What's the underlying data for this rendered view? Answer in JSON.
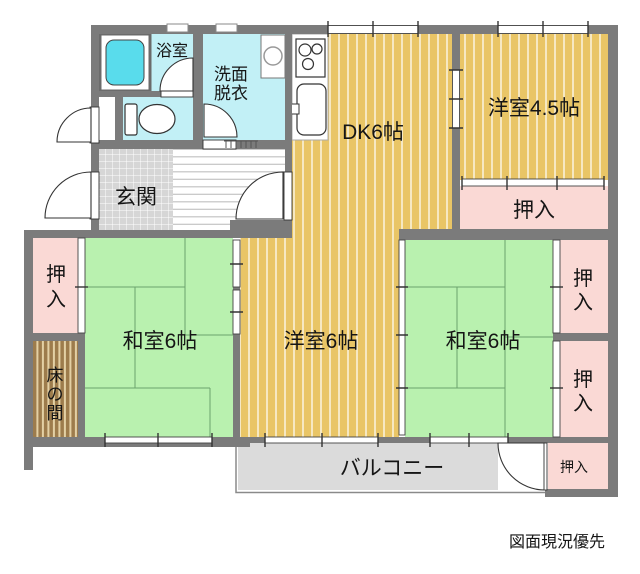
{
  "note": {
    "text": "図面現況優先"
  },
  "rooms": {
    "bathroom": {
      "label": "浴室"
    },
    "washroom": {
      "label_line1": "洗面",
      "label_line2": "脱衣"
    },
    "genkan": {
      "label": "玄関"
    },
    "dining_kitchen": {
      "label": "DK6帖"
    },
    "western_room_45": {
      "label": "洋室4.5帖"
    },
    "western_room_6": {
      "label": "洋室6帖"
    },
    "japanese_room_left": {
      "label": "和室6帖"
    },
    "japanese_room_right": {
      "label": "和室6帖"
    },
    "tokonoma": {
      "label": "床の間"
    },
    "balcony": {
      "label": "バルコニー"
    }
  },
  "closets": {
    "upper_right": {
      "label": "押入"
    },
    "left": {
      "label": "押入"
    },
    "right_top": {
      "label": "押入"
    },
    "right_bottom": {
      "label": "押入"
    },
    "balcony_side": {
      "label": "押入"
    }
  },
  "colors": {
    "wall": "#7b7b7b",
    "flooring": "#e9c566",
    "tatami": "#b9f1af",
    "closet": "#fad9d5",
    "wet": "#c2f0f6",
    "bathtub": "#59dcec",
    "tokonoma": "#9d7c4c",
    "balcony": "#dbdbdb",
    "tile": "#d6d6d6"
  }
}
